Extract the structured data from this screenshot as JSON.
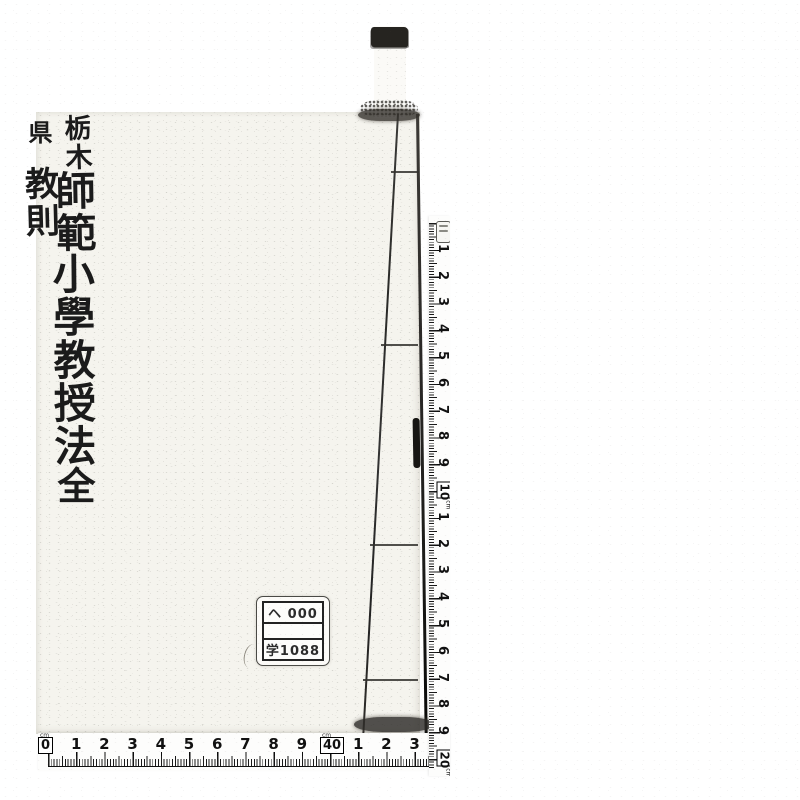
{
  "scan": {
    "description": "Scanned book cover with measuring tapes",
    "colors": {
      "paper": "#ffffff",
      "cover": "#f5f4ee",
      "ink": "#1b1b1b",
      "ruler_bg": "#fdfdfc",
      "binding": "#2a2a28"
    }
  },
  "book": {
    "title_right_top": "栃木",
    "title_right_mid": "師範",
    "title_main": "小學教授法",
    "title_left_top": "県",
    "title_left_mid": "教則",
    "volume": "全"
  },
  "label_box": {
    "row1": "ヘ 000",
    "row2": "",
    "row3": "学1088"
  },
  "rulers": {
    "unit": "cm",
    "right": {
      "labels": [
        "1",
        "2",
        "3",
        "4",
        "5",
        "6",
        "7",
        "8",
        "9",
        "10",
        "1",
        "2",
        "3",
        "4",
        "5",
        "6",
        "7",
        "8",
        "9",
        "20"
      ],
      "boxed_indices": [
        9,
        19
      ]
    },
    "bottom": {
      "labels": [
        "0",
        "1",
        "2",
        "3",
        "4",
        "5",
        "6",
        "7",
        "8",
        "9",
        "40",
        "1",
        "2",
        "3"
      ],
      "boxed_indices": [
        0,
        10
      ]
    }
  }
}
